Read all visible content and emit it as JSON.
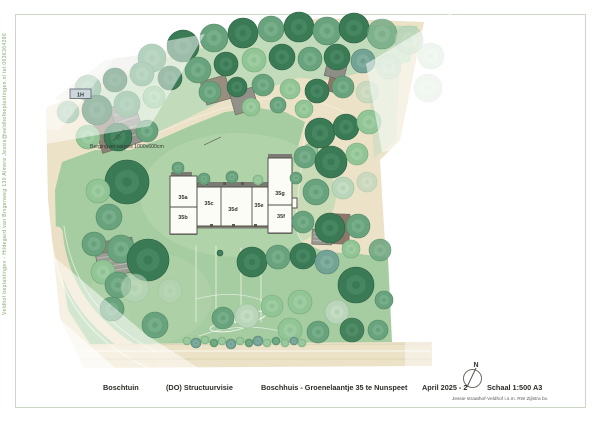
{
  "page": {
    "sidebar_text": "Veldhof beplantingen - Hildegard van Bingenweg 130 Almere    Jessie@veldhofbeplantingen.nl    tel:0636364286",
    "frame_color": "#ccd6c6"
  },
  "footer": {
    "project": "Boschtuin",
    "phase": "(DO) Structuurvisie",
    "subject": "Boschhuis - Groenelaantje 35 te Nunspeet",
    "date": "April 2025 - 2",
    "scale": "Schaal 1:500  A3",
    "credit": "Jessie straathof-Veldhof i.s.m. RW Zijlstra bv."
  },
  "plan": {
    "annotation": {
      "text": "Berging en carport 1000x600cm",
      "x": 90,
      "y": 148,
      "leaders": [
        [
          113,
          141,
          124,
          130
        ],
        [
          204,
          145,
          221,
          137
        ]
      ],
      "color": "#33332e"
    },
    "marker": {
      "text": "1H",
      "x": 70,
      "y": 89,
      "w": 21,
      "h": 9.5,
      "fill": "#cdd7db",
      "stroke": "#54626a",
      "text_color": "#2c373d"
    },
    "north": {
      "label": "N",
      "label_x": 476,
      "label_y": 367,
      "cx": 472.5,
      "cy": 378.5,
      "r": 9,
      "needle": [
        467,
        387,
        476,
        368
      ],
      "stroke": "#6a6a66"
    },
    "tree_palette": {
      "d": {
        "fill": "#3a7a55",
        "edge": "#2c5f42",
        "hi": "#5a9a72"
      },
      "m": {
        "fill": "#68a37d",
        "edge": "#4f8763",
        "hi": "#8cbd9b"
      },
      "l": {
        "fill": "#92c596",
        "edge": "#74ab79",
        "hi": "#b2d8b4"
      },
      "p": {
        "fill": "#b9d5ba",
        "edge": "#9cbf9e",
        "hi": "#d2e5d2"
      },
      "t": {
        "fill": "#72a394",
        "edge": "#577f74",
        "hi": "#93bdb0"
      }
    },
    "polygons": [
      {
        "name": "neighbor-plot-a",
        "points": "55,98 105,60 160,52 150,100 103,128",
        "fill": "#e8e8e4"
      },
      {
        "name": "neighbor-plot-b",
        "points": "160,52 200,42 188,88 150,100",
        "fill": "#dcdcd5"
      },
      {
        "name": "site-base-sand",
        "points": "46,108 150,60 240,34 320,18 424,22 400,140 380,160 386,260 390,342 432,342 432,366 84,368 60,318 48,200",
        "fill": "#ece2c7"
      },
      {
        "name": "upper-green-zone",
        "points": "96,92 152,62 232,40 312,24 418,26 410,62 372,70 330,80 298,78 262,90 224,100 188,118 158,132 120,120",
        "fill": "#c2dbba"
      },
      {
        "name": "right-green-sliver",
        "points": "368,72 400,64 396,140 374,158",
        "fill": "#c6debf",
        "opacity": 0.6
      },
      {
        "name": "main-lawn",
        "points": "62,162 95,150 130,150 158,140 190,126 225,112 258,108 285,112 305,122 297,150 290,185 292,220 302,242 325,252 360,254 388,258 390,300 392,342 90,344 68,310 56,235 55,190",
        "fill": "#a6cca1"
      }
    ],
    "ellipses": [
      {
        "name": "lawn-light-around-house",
        "cx": 238,
        "cy": 195,
        "rx": 98,
        "ry": 62,
        "rot": 0,
        "fill": "#b7d7af",
        "opacity": 0.65
      },
      {
        "name": "lawn-light-bottomleft",
        "cx": 150,
        "cy": 298,
        "rx": 62,
        "ry": 46,
        "rot": 0,
        "fill": "#b3d4ab",
        "opacity": 0.5
      },
      {
        "name": "hedge-oval-a",
        "cx": 250,
        "cy": 317,
        "rx": 16,
        "ry": 5,
        "rot": -12,
        "stroke": "#ffffff",
        "width": 1,
        "opacity": 0.85
      },
      {
        "name": "hedge-oval-b",
        "cx": 228,
        "cy": 327,
        "rx": 18,
        "ry": 4.5,
        "rot": -6,
        "stroke": "#ffffff",
        "width": 1,
        "opacity": 0.8
      }
    ],
    "strokes": [
      {
        "name": "driveway-arc-main",
        "d": "M57,232 Q66,318 152,360",
        "stroke": "#ebe0c5",
        "width": 11
      },
      {
        "name": "driveway-arc-edge-outer",
        "d": "M50,228 Q58,326 148,368",
        "stroke": "#ffffff",
        "width": 1.5,
        "opacity": 0.5
      },
      {
        "name": "driveway-arc-edge-inner",
        "d": "M64,226 Q74,308 156,352",
        "stroke": "#ffffff",
        "width": 1,
        "opacity": 0.55
      },
      {
        "name": "road-line-top",
        "d": "M76,345 L430,344",
        "stroke": "#cfc5a6",
        "width": 0.7,
        "opacity": 0.6
      },
      {
        "name": "road-line-mid",
        "d": "M78,351 L430,351",
        "stroke": "#ffffff",
        "width": 1,
        "opacity": 0.75
      },
      {
        "name": "road-line-low",
        "d": "M80,359 L430,359",
        "stroke": "#d8cdad",
        "width": 1,
        "opacity": 0.8
      },
      {
        "name": "path-edge-upper",
        "d": "M158,133 Q200,114 240,104 Q278,94 305,99 Q340,106 360,122",
        "stroke": "#ffffff",
        "width": 1,
        "opacity": 0.35
      },
      {
        "name": "path-edge-right",
        "d": "M306,124 Q300,180 296,215 Q294,238 308,246",
        "stroke": "#ffffff",
        "width": 1,
        "opacity": 0.5
      },
      {
        "name": "fence-line-1",
        "d": "M196,246 L196,322",
        "stroke": "#fdfdf8",
        "width": 0.8,
        "opacity": 0.8
      },
      {
        "name": "fence-line-2",
        "d": "M216,246 L216,322",
        "stroke": "#fdfdf8",
        "width": 0.8,
        "opacity": 0.8
      },
      {
        "name": "fence-line-3",
        "d": "M241,248 L241,322",
        "stroke": "#fdfdf8",
        "width": 0.8,
        "opacity": 0.8
      },
      {
        "name": "fence-line-4",
        "d": "M261,250 L261,322",
        "stroke": "#fdfdf8",
        "width": 0.8,
        "opacity": 0.8
      },
      {
        "name": "lawn-contour-a",
        "d": "M196,299 Q238,288 268,303",
        "stroke": "#ffffff",
        "width": 0.8,
        "opacity": 0.6
      },
      {
        "name": "lawn-contour-b",
        "d": "M199,336 Q243,320 287,333",
        "stroke": "#ffffff",
        "width": 0.8,
        "opacity": 0.6
      }
    ],
    "buildings": [
      {
        "name": "carport-topleft-shed",
        "cx": 107,
        "cy": 131,
        "w": 22,
        "h": 40,
        "rot": -18,
        "fill": "#8a7e71"
      },
      {
        "name": "carport-topleft-roof",
        "cx": 128,
        "cy": 124,
        "w": 25,
        "h": 42,
        "rot": -18,
        "fill": "#8f908a",
        "stripes": 4,
        "stripe_color": "#b7b8b0"
      },
      {
        "name": "neighbor-shed-top-1",
        "cx": 216,
        "cy": 90,
        "w": 26,
        "h": 24,
        "rot": -16,
        "fill": "#97897b"
      },
      {
        "name": "neighbor-shed-top-2",
        "cx": 244,
        "cy": 101,
        "w": 24,
        "h": 22,
        "rot": -16,
        "fill": "#8d8c86"
      },
      {
        "name": "neighbor-shed-topright-1",
        "cx": 336,
        "cy": 69,
        "w": 20,
        "h": 18,
        "rot": 14,
        "fill": "#8b8a84"
      },
      {
        "name": "neighbor-shed-topright-2",
        "cx": 337,
        "cy": 86,
        "w": 18,
        "h": 14,
        "rot": 14,
        "fill": "#8a7162"
      },
      {
        "name": "building-right-brown",
        "cx": 341,
        "cy": 229,
        "w": 17,
        "h": 30,
        "rot": 2,
        "fill": "#8a7164"
      },
      {
        "name": "building-right-gray",
        "cx": 322,
        "cy": 237,
        "w": 20,
        "h": 15,
        "rot": 2,
        "fill": "#94948e",
        "stripes": 3,
        "stripe_color": "#b4b4ac"
      },
      {
        "name": "carport-bottomleft-brown",
        "cx": 114,
        "cy": 246,
        "w": 38,
        "h": 12,
        "rot": -9,
        "fill": "#96866e"
      },
      {
        "name": "carport-bottomleft-gray",
        "cx": 114,
        "cy": 263,
        "w": 34,
        "h": 24,
        "rot": -9,
        "fill": "#9a9a94",
        "stripes": 4,
        "stripe_color": "#bbbbb3"
      }
    ],
    "house": {
      "fill": "#fcfcf7",
      "stroke": "#50504a",
      "strip_color": "#7b7b74",
      "chimney_color": "#5a5a54",
      "label_color": "#32322d",
      "rects": [
        [
          170,
          176,
          27,
          58
        ],
        [
          197,
          187,
          71,
          39
        ],
        [
          268,
          158,
          24,
          75
        ],
        [
          292,
          198,
          5,
          10
        ]
      ],
      "strips": [
        [
          197,
          182,
          71,
          4.5
        ],
        [
          197,
          225,
          71,
          3.5
        ],
        [
          268,
          154,
          24,
          4
        ],
        [
          171,
          172,
          21,
          4
        ],
        [
          170,
          232,
          27,
          3
        ],
        [
          268,
          231,
          24,
          3
        ]
      ],
      "chimneys": [
        [
          205,
          182
        ],
        [
          223,
          182
        ],
        [
          241,
          182
        ],
        [
          259,
          182
        ],
        [
          210,
          224
        ],
        [
          232,
          224
        ],
        [
          254,
          224
        ]
      ],
      "dividers": [
        [
          221,
          187,
          221,
          226
        ],
        [
          252,
          187,
          252,
          226
        ],
        [
          170,
          207,
          197,
          207
        ],
        [
          268,
          205,
          292,
          205
        ]
      ],
      "labels": [
        {
          "t": "35a",
          "x": 183,
          "y": 199
        },
        {
          "t": "35b",
          "x": 183,
          "y": 219
        },
        {
          "t": "35c",
          "x": 209,
          "y": 205
        },
        {
          "t": "35d",
          "x": 233,
          "y": 211
        },
        {
          "t": "35e",
          "x": 259,
          "y": 207
        },
        {
          "t": "35g",
          "x": 280,
          "y": 195
        },
        {
          "t": "35f",
          "x": 281,
          "y": 218
        }
      ]
    },
    "trees": [
      [
        152,
        58,
        14,
        "m"
      ],
      [
        183,
        46,
        16,
        "d"
      ],
      [
        214,
        38,
        14,
        "m"
      ],
      [
        243,
        33,
        15,
        "d"
      ],
      [
        271,
        29,
        13,
        "m"
      ],
      [
        299,
        27,
        15,
        "d"
      ],
      [
        327,
        31,
        14,
        "m"
      ],
      [
        354,
        28,
        15,
        "d"
      ],
      [
        382,
        34,
        15,
        "m",
        0.75
      ],
      [
        409,
        40,
        14,
        "p",
        0.7
      ],
      [
        431,
        56,
        13,
        "p",
        0.5
      ],
      [
        428,
        88,
        14,
        "p",
        0.45
      ],
      [
        170,
        78,
        12,
        "d"
      ],
      [
        198,
        70,
        13,
        "m"
      ],
      [
        226,
        64,
        12,
        "d"
      ],
      [
        254,
        60,
        12,
        "l"
      ],
      [
        282,
        57,
        13,
        "d"
      ],
      [
        310,
        59,
        12,
        "m"
      ],
      [
        337,
        57,
        13,
        "d"
      ],
      [
        363,
        61,
        12,
        "t"
      ],
      [
        389,
        67,
        12,
        "p",
        0.6
      ],
      [
        210,
        92,
        11,
        "m"
      ],
      [
        237,
        87,
        10,
        "d"
      ],
      [
        263,
        85,
        11,
        "m"
      ],
      [
        290,
        89,
        10,
        "l"
      ],
      [
        317,
        91,
        12,
        "d"
      ],
      [
        343,
        87,
        11,
        "m"
      ],
      [
        367,
        92,
        11,
        "p",
        0.65
      ],
      [
        251,
        107,
        9,
        "l"
      ],
      [
        278,
        105,
        8,
        "m"
      ],
      [
        304,
        109,
        9,
        "l"
      ],
      [
        88,
        88,
        13,
        "m"
      ],
      [
        115,
        80,
        12,
        "d"
      ],
      [
        142,
        74,
        12,
        "m"
      ],
      [
        68,
        112,
        11,
        "m",
        0.85
      ],
      [
        97,
        110,
        15,
        "d"
      ],
      [
        127,
        104,
        13,
        "m"
      ],
      [
        154,
        97,
        11,
        "l"
      ],
      [
        88,
        137,
        12,
        "l"
      ],
      [
        118,
        137,
        14,
        "d"
      ],
      [
        147,
        131,
        11,
        "m"
      ],
      [
        127,
        182,
        22,
        "d"
      ],
      [
        98,
        191,
        12,
        "l"
      ],
      [
        109,
        217,
        13,
        "m"
      ],
      [
        94,
        244,
        12,
        "m"
      ],
      [
        121,
        249,
        14,
        "m"
      ],
      [
        103,
        272,
        12,
        "l"
      ],
      [
        148,
        260,
        21,
        "d"
      ],
      [
        118,
        285,
        13,
        "m"
      ],
      [
        135,
        288,
        14,
        "p",
        0.6
      ],
      [
        112,
        309,
        12,
        "m"
      ],
      [
        155,
        325,
        13,
        "m"
      ],
      [
        170,
        291,
        12,
        "p",
        0.5
      ],
      [
        178,
        168,
        6,
        "m"
      ],
      [
        204,
        179,
        6,
        "m"
      ],
      [
        232,
        177,
        6,
        "m"
      ],
      [
        258,
        180,
        5,
        "l"
      ],
      [
        296,
        178,
        6,
        "m"
      ],
      [
        311,
        150,
        7,
        "l"
      ],
      [
        320,
        133,
        15,
        "d"
      ],
      [
        346,
        127,
        13,
        "d"
      ],
      [
        369,
        122,
        12,
        "l"
      ],
      [
        305,
        157,
        11,
        "m"
      ],
      [
        331,
        162,
        16,
        "d"
      ],
      [
        357,
        154,
        11,
        "l"
      ],
      [
        316,
        192,
        13,
        "m"
      ],
      [
        343,
        188,
        11,
        "p"
      ],
      [
        367,
        182,
        10,
        "p",
        0.65
      ],
      [
        303,
        222,
        11,
        "m"
      ],
      [
        330,
        228,
        15,
        "d"
      ],
      [
        358,
        226,
        12,
        "m"
      ],
      [
        380,
        250,
        11,
        "m",
        0.85
      ],
      [
        351,
        249,
        9,
        "l"
      ],
      [
        252,
        262,
        15,
        "d"
      ],
      [
        278,
        257,
        12,
        "m"
      ],
      [
        303,
        256,
        13,
        "d"
      ],
      [
        327,
        262,
        12,
        "t"
      ],
      [
        356,
        285,
        18,
        "d"
      ],
      [
        384,
        300,
        9,
        "m"
      ],
      [
        337,
        312,
        12,
        "p"
      ],
      [
        300,
        302,
        12,
        "l"
      ],
      [
        272,
        306,
        11,
        "l"
      ],
      [
        247,
        316,
        12,
        "p"
      ],
      [
        223,
        318,
        11,
        "m"
      ],
      [
        290,
        330,
        12,
        "l"
      ],
      [
        318,
        332,
        11,
        "m"
      ],
      [
        352,
        330,
        12,
        "d",
        0.9
      ],
      [
        378,
        330,
        10,
        "m"
      ],
      [
        220,
        253,
        3,
        "d"
      ]
    ],
    "shrubs": [
      [
        187,
        341,
        4,
        "l"
      ],
      [
        196,
        343,
        5,
        "t"
      ],
      [
        205,
        340,
        4,
        "l"
      ],
      [
        214,
        343,
        4,
        "m"
      ],
      [
        222,
        341,
        4,
        "l"
      ],
      [
        231,
        344,
        5,
        "t"
      ],
      [
        240,
        341,
        4,
        "l"
      ],
      [
        249,
        343,
        4,
        "m"
      ],
      [
        258,
        341,
        5,
        "t"
      ],
      [
        267,
        343,
        4,
        "l"
      ],
      [
        276,
        341,
        4,
        "m"
      ],
      [
        285,
        343,
        4,
        "l"
      ],
      [
        294,
        341,
        4,
        "t"
      ],
      [
        302,
        343,
        4,
        "l"
      ]
    ],
    "overlays": [
      {
        "name": "fade-topleft",
        "points": "38,64 205,34 150,126 40,145",
        "opacity": 0.5
      },
      {
        "name": "fade-topleft-corner",
        "points": "38,64 120,50 60,130 38,130",
        "opacity": 0.4
      },
      {
        "name": "fade-right",
        "points": "366,64 452,12 448,142 382,152",
        "opacity": 0.55
      },
      {
        "name": "fade-bottomleft",
        "points": "40,245 148,336 205,372 52,372 38,305",
        "opacity": 0.5
      },
      {
        "name": "fade-bottomleft-corner",
        "points": "38,300 120,372 38,372",
        "opacity": 0.65
      },
      {
        "name": "fade-road-right-end",
        "points": "405,340 436,340 436,368 405,368",
        "opacity": 0.45
      }
    ]
  }
}
